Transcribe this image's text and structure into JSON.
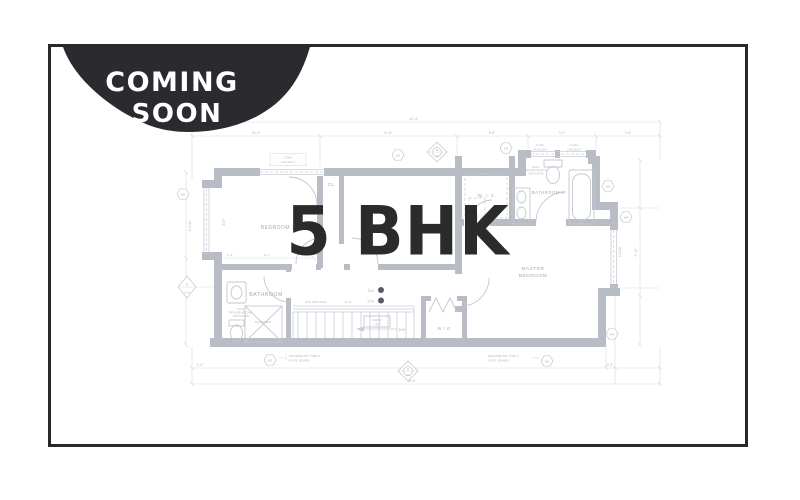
{
  "badge": {
    "line1": "COMING",
    "line2": "SOON"
  },
  "overlay": {
    "title": "5 BHK"
  },
  "colors": {
    "frame_border": "#28282c",
    "badge_bg": "#2b2b2f",
    "badge_text": "#ffffff",
    "title_text": "#2b2b2b",
    "plan_wall": "#b8bcc5",
    "plan_line": "#c9cdd5",
    "plan_text": "#a4aab5",
    "detector_dot": "#575c64"
  },
  "floor_plan": {
    "rooms": {
      "bedroom3": "BEDROOM 3",
      "closet": "CL",
      "wic": "W. I. C.",
      "bathroom2": "BATHROOM 2",
      "master_line1": "MASTER",
      "master_line2": "BEDROOM",
      "bathroom": "BATHROOM",
      "shower": "SHOWER",
      "washer_dryer": "W / D",
      "stairs_dn": "DN"
    },
    "detectors": {
      "smoke": "SA",
      "co": "CO"
    },
    "notes": {
      "header": {
        "line1": "2-2x8+",
        "line2": "L4x3.5x1/4"
      },
      "gypsum": {
        "line1": "PROVIDE 5/8\" TYPE X",
        "line2": "GYPS. BOARD"
      },
      "vent": {
        "line1": "NOTE:",
        "line2": "PROVIDE MECHAN.",
        "line3": "VENTILATION"
      },
      "stair": {
        "line1": "16R @",
        "line2": "7-3/4\""
      },
      "rail": "2'-8\" HIGH RAIL",
      "framing": "2-2x10"
    },
    "dims": {
      "overall_top": "41'-4\"",
      "d1": "16'-4\"",
      "d2": "11'-6\"",
      "d3": "6'-8\"",
      "d4": "3'-0\"",
      "d5": "2'-8\"",
      "b1": "1'-4\"",
      "b2": "2'-4\"",
      "overall_bottom": "45'-0\"",
      "w1": "1'-4\"",
      "w2": "6'-4\"",
      "hall": "11'-6\"",
      "left_rot": "8'-6\"",
      "right_rot": "5'-10\""
    },
    "callouts": {
      "w2": "W2",
      "w3": "W3",
      "w4": "W4",
      "w5": "W5",
      "w6": "W6",
      "a_top": "A",
      "a_sheet": "A-10",
      "b_top": "B",
      "b_sheet": "A-6"
    }
  }
}
